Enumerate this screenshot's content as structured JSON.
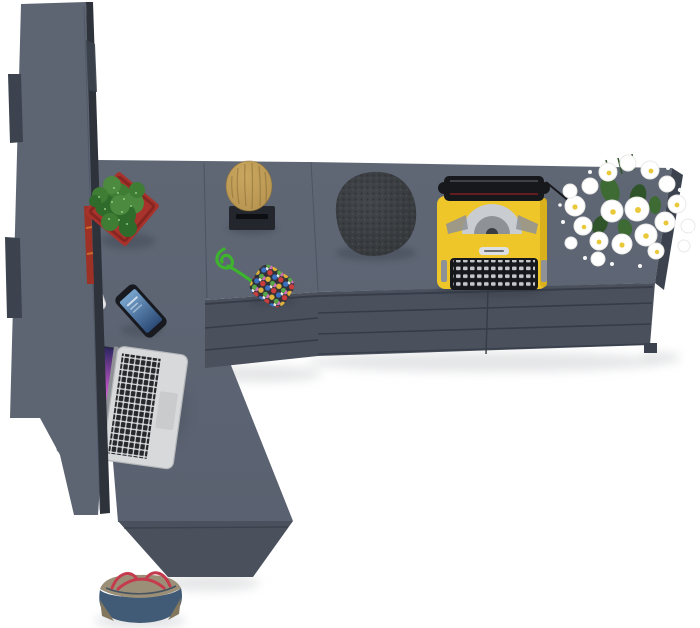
{
  "scene": {
    "label": "Top-down 3D render of a dark gray L-shaped office furniture set with decor objects",
    "items": [
      {
        "name": "tall-wardrobe",
        "color_key": "wardrobe_top"
      },
      {
        "name": "desk-return-surface",
        "color_key": "surface_top"
      },
      {
        "name": "sideboard-with-drawers",
        "color_key": "front_face"
      },
      {
        "name": "cactus-in-red-pot",
        "color_key": "pot_red"
      },
      {
        "name": "wooden-stump-on-tray",
        "color_key": "stump_wood"
      },
      {
        "name": "bead-pouch-with-green-cord",
        "color_key": "bead_bg"
      },
      {
        "name": "lava-stone",
        "color_key": "rock_mid"
      },
      {
        "name": "yellow-typewriter",
        "color_key": "tw_yellow"
      },
      {
        "name": "daisy-bouquet",
        "color_key": "flower_white"
      },
      {
        "name": "silver-laptop",
        "color_key": "laptop_silver"
      },
      {
        "name": "smartphone",
        "color_key": "phone_body"
      },
      {
        "name": "white-pen",
        "color_key": "pen_white"
      },
      {
        "name": "canvas-handbag",
        "color_key": "bag_blue"
      }
    ]
  },
  "colors": {
    "bg": "#ffffff",
    "surface_top": "#5a6170",
    "surface_top_light": "#5f6775",
    "wardrobe_top": "#5d6573",
    "wardrobe_side": "#3c434e",
    "front_face": "#4a515d",
    "front_groove": "#363c47",
    "strip_dark": "#2d323b",
    "books_red": "#9e3125",
    "books_orange": "#c96a2f",
    "pot_red": "#a8322c",
    "pot_red_dark": "#7e231f",
    "cactus_green": "#4c8a3f",
    "cactus_mid": "#3f7d35",
    "cactus_dark": "#2f6b2a",
    "cactus_light": "#9fcf8a",
    "stump_wood": "#b3914f",
    "stump_grain": "#866a33",
    "stump_light": "#c9a75f",
    "tray_black": "#23262c",
    "tray_slot": "#0e0f12",
    "rock_mid": "#43464a",
    "rock_dark": "#34373a",
    "rock_speck_dark": "#2b2d30",
    "rock_speck_light": "#575a5e",
    "tw_yellow": "#eec62a",
    "tw_yellow_dark": "#d4ab1a",
    "tw_black": "#17181b",
    "tw_silver": "#c9ccd1",
    "tw_silver_dark": "#8e9196",
    "tw_red": "#7e1f1f",
    "key_light": "#c3c6cb",
    "flower_white": "#ffffff",
    "flower_edge": "#e9e9e6",
    "flower_center": "#e9c83a",
    "leaf_green": "#3e6b34",
    "leaf_dark": "#2f5429",
    "laptop_silver": "#d7d9db",
    "laptop_edge": "#b4b6b9",
    "lkey_dark": "#26282c",
    "trackpad": "#c9cbcd",
    "scr1": "#2c2560",
    "scr2": "#d85fd8",
    "scr3": "#8a35b5",
    "scr4": "#3a1f55",
    "phone_body": "#181a1f",
    "phone_scr1": "#76a3cc",
    "phone_scr2": "#2c4c77",
    "cord_green": "#3db32e",
    "bead_bg": "#2e3138",
    "bead1": "#cc3d3d",
    "bead2": "#3b6fc2",
    "bead3": "#e0b33a",
    "bead4": "#58a84a",
    "bead5": "#cf6fb8",
    "bead6": "#ece8df",
    "bag_blue": "#415a75",
    "bag_blue_dark": "#31455c",
    "bag_khaki": "#9b8f77",
    "bag_khaki_dark": "#82765f",
    "bag_red": "#c53b4e",
    "pen_white": "#e9e9ec",
    "shadow": "#dadbdd",
    "obj_shadow": "#2f353f"
  }
}
